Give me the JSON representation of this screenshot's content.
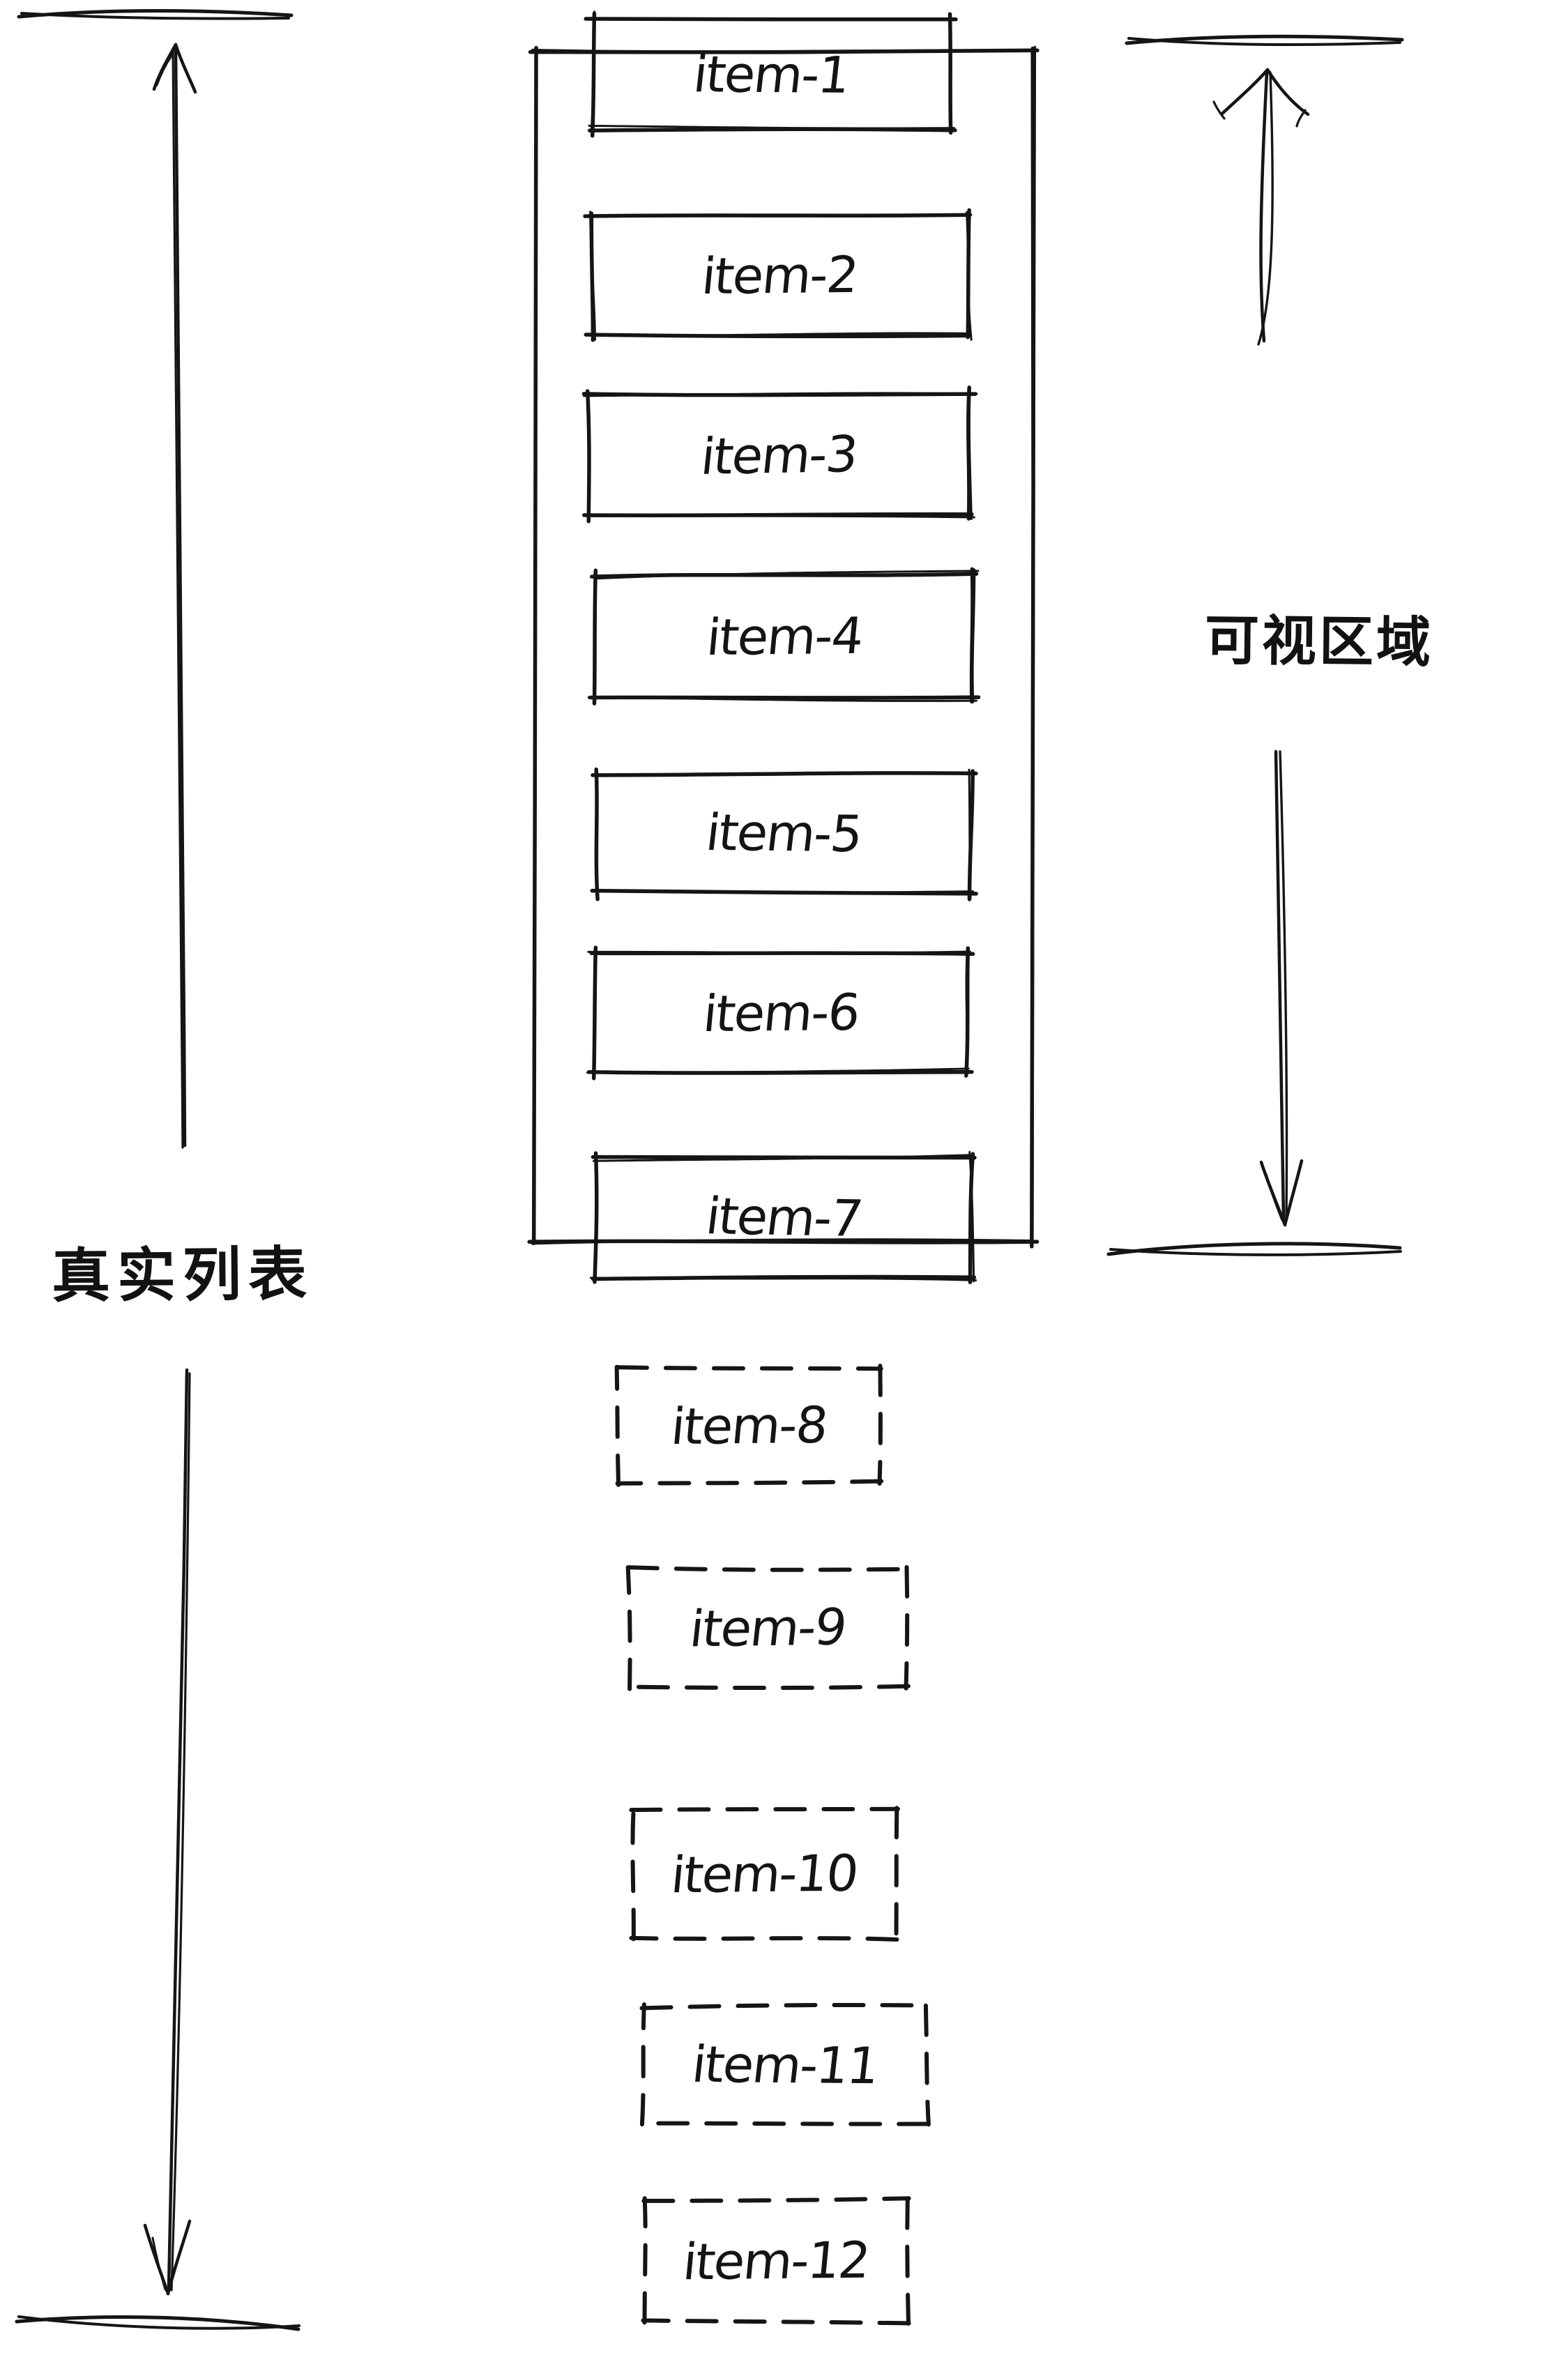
{
  "page": {
    "background": "#ffffff",
    "ink": "#151515",
    "description_visible_text_only": true
  },
  "items": [
    {
      "label": "item-1",
      "style": "solid",
      "in_viewport": true
    },
    {
      "label": "item-2",
      "style": "solid",
      "in_viewport": true
    },
    {
      "label": "item-3",
      "style": "solid",
      "in_viewport": true
    },
    {
      "label": "item-4",
      "style": "solid",
      "in_viewport": true
    },
    {
      "label": "item-5",
      "style": "solid",
      "in_viewport": true
    },
    {
      "label": "item-6",
      "style": "solid",
      "in_viewport": true
    },
    {
      "label": "item-7",
      "style": "solid",
      "in_viewport": true
    },
    {
      "label": "item-8",
      "style": "dashed",
      "in_viewport": false
    },
    {
      "label": "item-9",
      "style": "dashed",
      "in_viewport": false
    },
    {
      "label": "item-10",
      "style": "dashed",
      "in_viewport": false
    },
    {
      "label": "item-11",
      "style": "dashed",
      "in_viewport": false
    },
    {
      "label": "item-12",
      "style": "dashed",
      "in_viewport": false
    }
  ],
  "annotations": {
    "real_list_label": "真实列表",
    "viewport_label": "可视区域"
  }
}
